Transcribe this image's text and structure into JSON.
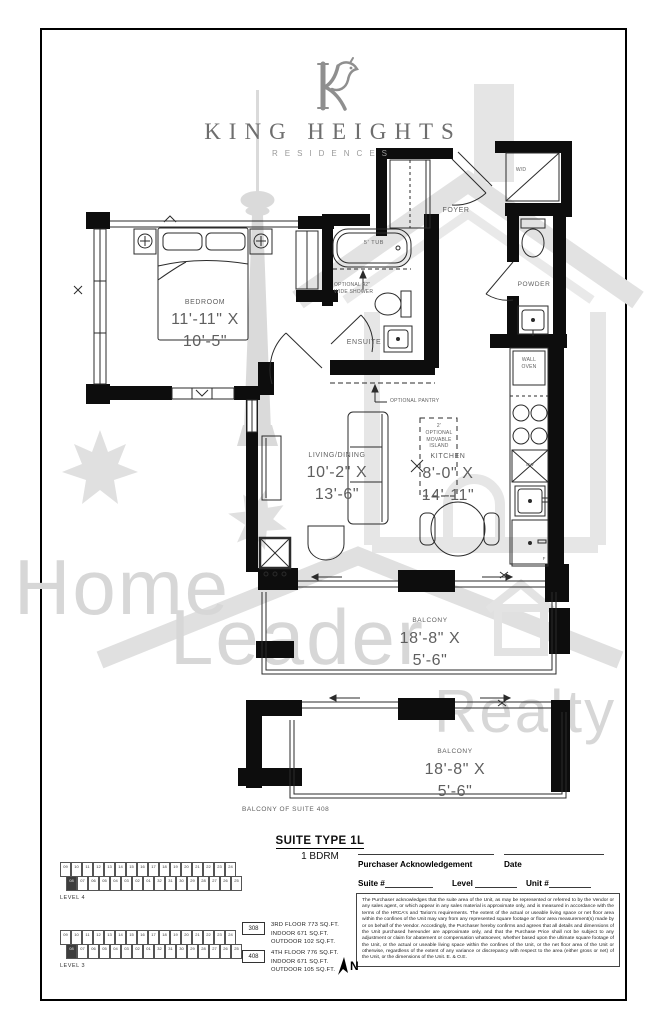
{
  "branding": {
    "name": "KING HEIGHTS",
    "tagline": "RESIDENCES"
  },
  "watermark": {
    "words": [
      "Home",
      "Leader",
      "Realty"
    ]
  },
  "plan": {
    "labels": {
      "foyer": "FOYER",
      "wd": "W/D",
      "powder": "POWDER",
      "wall_oven": "WALL\nOVEN",
      "dw": "DW",
      "fridge": "F",
      "tub": "5' TUB",
      "shower": "OPTIONAL 42\"\nWIDE SHOWER",
      "ensuite": "ENSUITE",
      "pantry": "OPTIONAL PANTRY",
      "island": "2'\nOPTIONAL\nMOVABLE\nISLAND",
      "bedroom": {
        "name": "BEDROOM",
        "dims": "11'-11\" X 10'-5\""
      },
      "living": {
        "name": "LIVING/DINING",
        "dims": "10'-2\" X 13'-6\""
      },
      "kitchen": {
        "name": "KITCHEN",
        "dims": "8'-0\" X 14'-11\""
      },
      "balcony_upper": {
        "name": "BALCONY",
        "dims": "18'-8\" X 5'-6\""
      },
      "balcony_lower": {
        "name": "BALCONY",
        "dims": "18'-8\" X 5'-6\""
      },
      "balcony_note": "BALCONY OF SUITE 408"
    }
  },
  "footer": {
    "suite_type": "SUITE TYPE 1L",
    "suite_desc": "1 BDRM",
    "ack": {
      "purchaser": "Purchaser Acknowledgement",
      "date": "Date",
      "suite": "Suite #",
      "level": "Level",
      "unit": "Unit #"
    },
    "legal": "The Purchaser acknowledges that the suite area of the Unit, as may be represented or referred to by the Vendor or any sales agent, or which appear in any sales material is approximate only, and is measured in accordance with the terms of the HRCA's and Tarion's requirements.  The extent of the actual or useable living space or net floor area within the confines of the Unit may vary from any represented square footage or floor area measurement(s) made by or on behalf of the Vendor. Accordingly, the Purchaser hereby confirms and agrees that all details and dimensions of the Unit purchased hereunder are approximate only, and that the Purchase Price shall not be subject to any adjustment or claim for abatement or compensation whatsoever, whether based upon the ultimate square footage of the Unit, or the actual or useable living space within the confines of the Unit, or the net floor area of the Unit or otherwise, regardless of the extent of any variance or discrepancy with respect to the area (either gross or net) of the Unit, or the dimensions of the Unit. E. & O.E.",
    "stats": [
      {
        "code": "308",
        "lines": [
          "3RD FLOOR 773 SQ.FT.",
          "INDOOR 671 SQ.FT.",
          "OUTDOOR 102 SQ.FT."
        ]
      },
      {
        "code": "408",
        "lines": [
          "4TH FLOOR 776 SQ.FT.",
          "INDOOR 671 SQ.FT.",
          "OUTDOOR 105 SQ.FT."
        ]
      }
    ],
    "north": "N",
    "keyplans": [
      {
        "label": "LEVEL 4",
        "highlight": "08",
        "top": [
          "09",
          "10",
          "11",
          "12",
          "13",
          "14",
          "15",
          "16",
          "17",
          "18",
          "19",
          "20",
          "21",
          "22",
          "23",
          "24"
        ],
        "bottom": [
          "08",
          "07",
          "06",
          "05",
          "04",
          "03",
          "02",
          "01",
          "32",
          "31",
          "30",
          "29",
          "28",
          "27",
          "26",
          "25"
        ]
      },
      {
        "label": "LEVEL 3",
        "highlight": "08",
        "top": [
          "09",
          "10",
          "11",
          "12",
          "13",
          "14",
          "15",
          "16",
          "17",
          "18",
          "19",
          "20",
          "21",
          "22",
          "23",
          "24"
        ],
        "bottom": [
          "08",
          "07",
          "06",
          "05",
          "04",
          "03",
          "02",
          "01",
          "32",
          "31",
          "30",
          "29",
          "28",
          "27",
          "26",
          "25"
        ]
      }
    ]
  }
}
